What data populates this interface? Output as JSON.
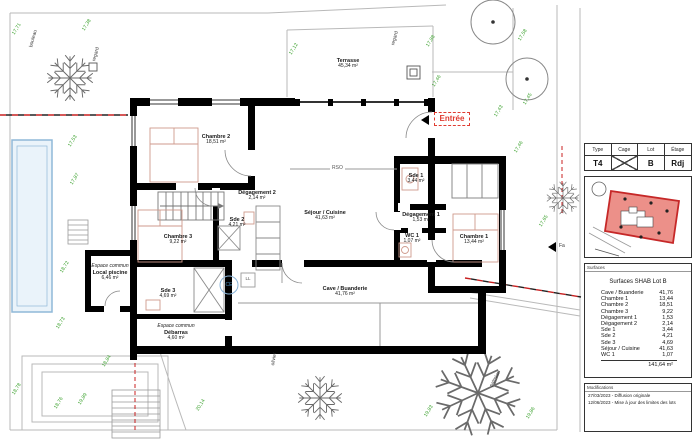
{
  "plan": {
    "rooms": [
      {
        "name": "Terrasse",
        "area": "45,34 m²"
      },
      {
        "name": "Chambre 2",
        "area": "18,51 m²"
      },
      {
        "name": "Dégagement 2",
        "area": "2,14 m²"
      },
      {
        "name": "Sde 2",
        "area": "4,21 m²"
      },
      {
        "name": "Chambre 3",
        "area": "9,22 m²"
      },
      {
        "name": "Sde 3",
        "area": "4,69 m²"
      },
      {
        "prefix": "Espace commun",
        "name": "Local piscine",
        "area": "6,46 m²"
      },
      {
        "prefix": "Espace commun",
        "name": "Débarras",
        "area": "4,60 m²"
      },
      {
        "name": "Séjour / Cuisine",
        "area": "41,63 m²"
      },
      {
        "name": "Sde 1",
        "area": "3,44 m²"
      },
      {
        "name": "Dégagement 1",
        "area": "1,53 m²"
      },
      {
        "name": "WC 1",
        "area": "1,07 m²"
      },
      {
        "name": "Chambre 1",
        "area": "13,44 m²"
      },
      {
        "name": "Cave / Buanderie",
        "area": "41,76 m²"
      }
    ],
    "entrance_label": "Entrée",
    "symbols": {
      "ce": "CE",
      "ll": "LL",
      "rso": "RSO",
      "fa": "Fa"
    },
    "site_labels": [
      "bouleau",
      "regard",
      "regard",
      "olivier",
      "palmier"
    ],
    "elevations": [
      "17,71",
      "17,38",
      "17,12",
      "17,58",
      "17,88",
      "17,46",
      "17,43",
      "17,45",
      "17,53",
      "17,87",
      "18,72",
      "18,73",
      "18,84",
      "18,78",
      "18,76",
      "19,89",
      "20,14",
      "19,83",
      "19,86",
      "17,65",
      "17,46"
    ],
    "colors": {
      "elevation_text": "#3da22f",
      "boundary_line": "#c82020",
      "entrance_red": "#e03c31"
    }
  },
  "title_block": {
    "header": {
      "columns": [
        "Type",
        "Cage",
        "Lot",
        "Étage"
      ],
      "type_value": "T4",
      "lot_value": "B",
      "etage_value": "Rdj"
    },
    "surfaces": {
      "section_label": "Surfaces",
      "title": "Surfaces SHAB Lot B",
      "rows": [
        {
          "label": "Cave / Buanderie",
          "value": "41,76"
        },
        {
          "label": "Chambre 1",
          "value": "13,44"
        },
        {
          "label": "Chambre 2",
          "value": "18,51"
        },
        {
          "label": "Chambre 3",
          "value": "9,22"
        },
        {
          "label": "Dégagement 1",
          "value": "1,53"
        },
        {
          "label": "Dégagement 2",
          "value": "2,14"
        },
        {
          "label": "Sde 1",
          "value": "3,44"
        },
        {
          "label": "Sde 2",
          "value": "4,21"
        },
        {
          "label": "Sde 3",
          "value": "4,69"
        },
        {
          "label": "Séjour / Cuisine",
          "value": "41,63"
        },
        {
          "label": "WC 1",
          "value": "1,07"
        }
      ],
      "total": "141,64 m²"
    },
    "modifications": {
      "section_label": "Modifications",
      "entries": [
        "27/03/2023 - Diffusion originale",
        "12/06/2023 - Mise à jour des limites des lots"
      ]
    }
  }
}
